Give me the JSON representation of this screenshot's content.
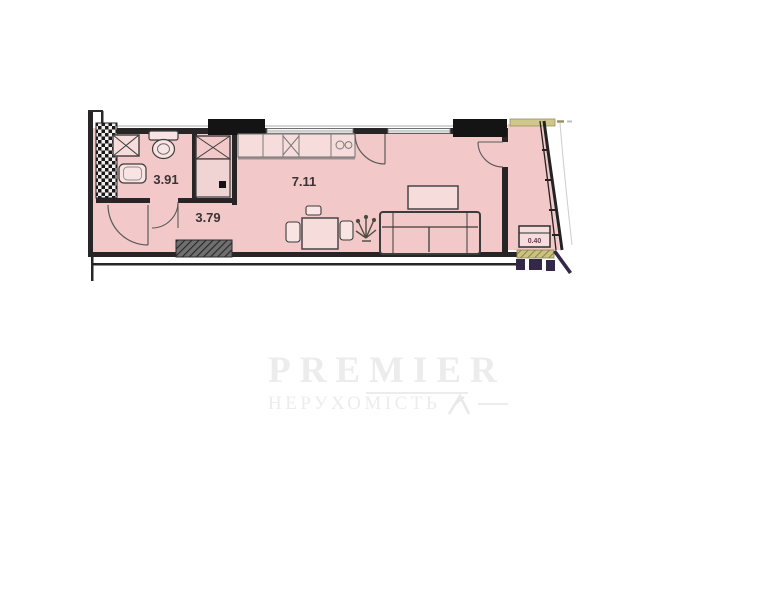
{
  "watermark": {
    "brand": "PREMIER",
    "subtitle": "НЕРУХОМІСТЬ"
  },
  "plan": {
    "rooms": [
      {
        "name": "bathroom",
        "area": "3.91"
      },
      {
        "name": "hallway",
        "area": "3.79"
      },
      {
        "name": "kitchen-living",
        "area": "7.11"
      },
      {
        "name": "balcony",
        "area": "0.40"
      }
    ],
    "colors": {
      "room_fill": "#f2c9c8",
      "room_fill_light": "#f6dcdb",
      "wall": "#272525",
      "band_olive": "#c8c17c",
      "hatch_dark": "#332847",
      "label": "#3b3336",
      "watermark": "#ececec"
    }
  }
}
